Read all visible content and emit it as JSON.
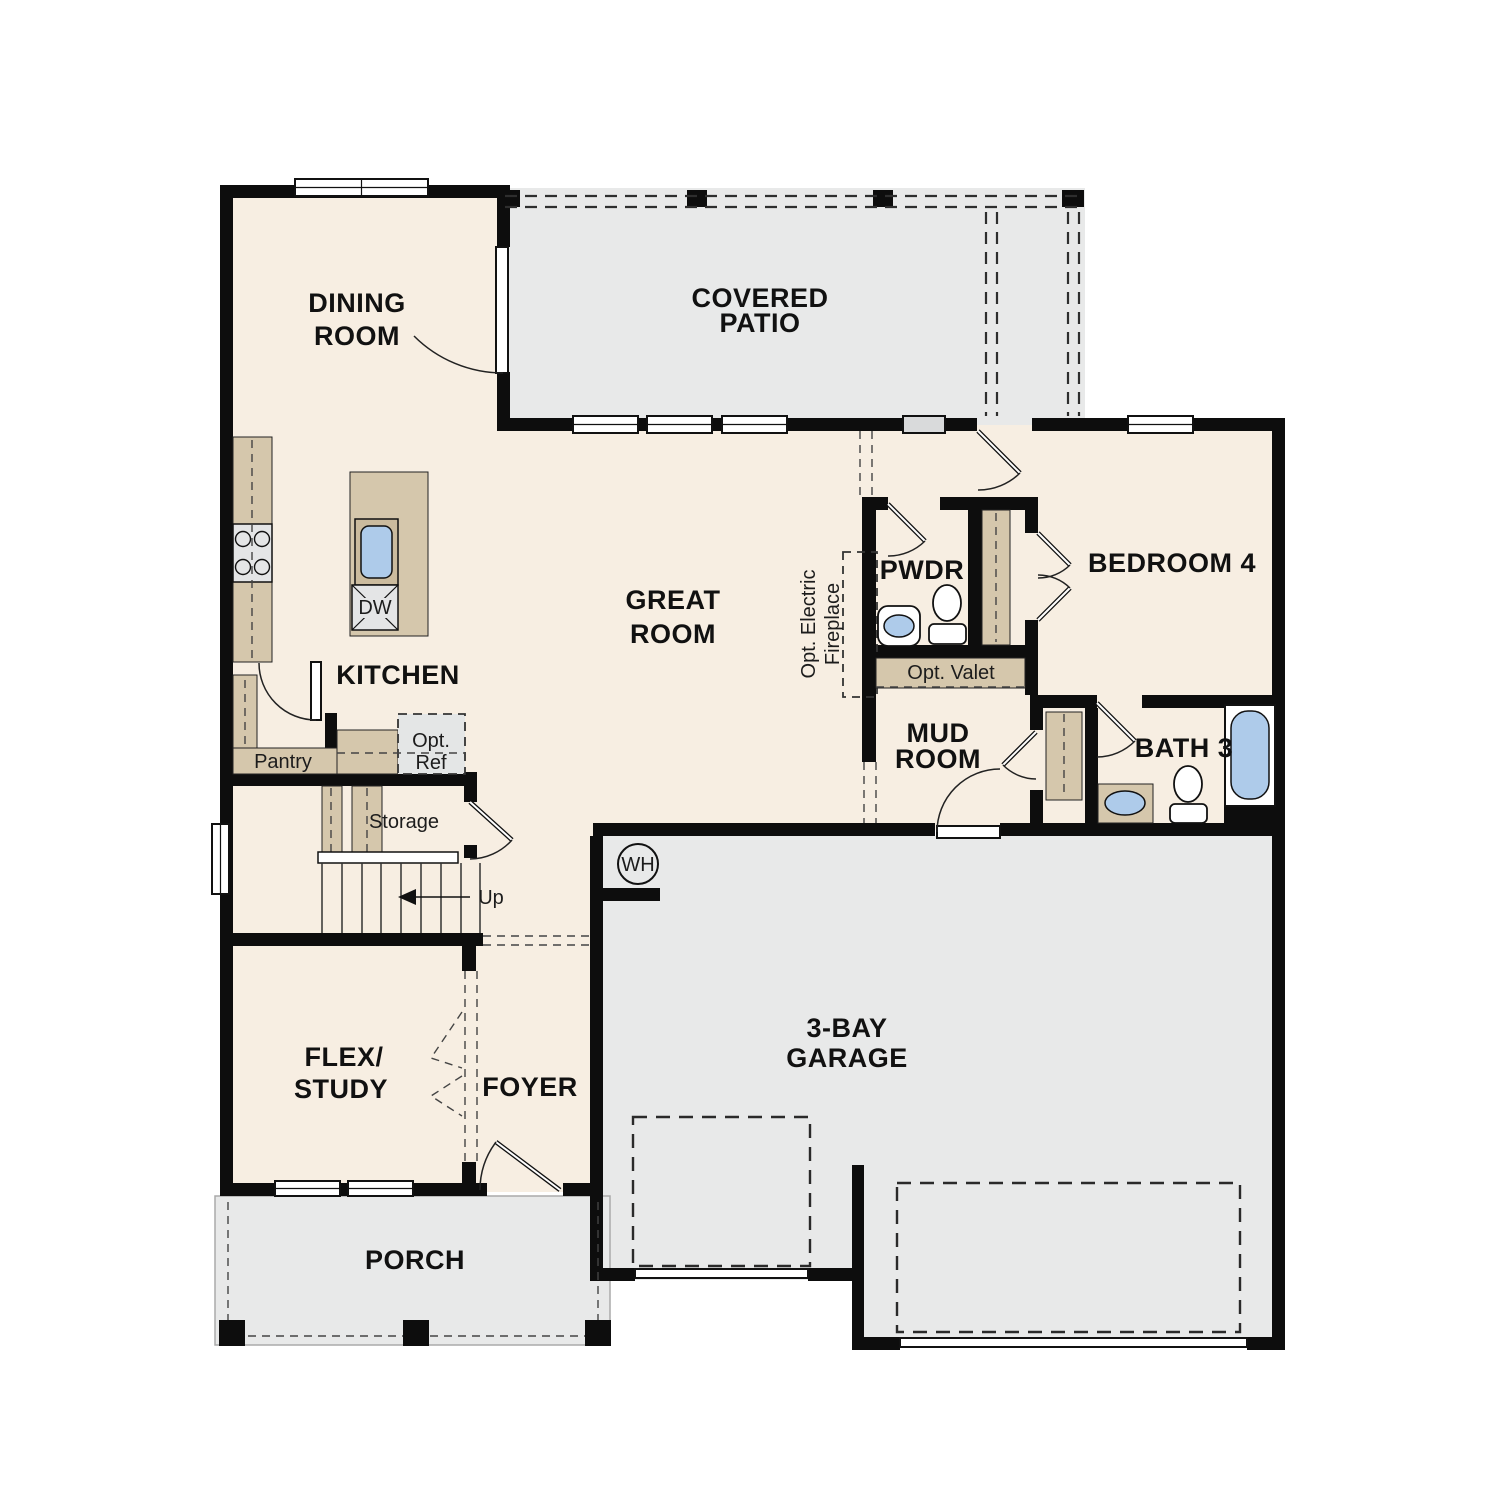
{
  "plan": {
    "rooms": {
      "dining": {
        "line1": "DINING",
        "line2": "ROOM"
      },
      "covered_patio": {
        "line1": "COVERED",
        "line2": "PATIO"
      },
      "great_room": {
        "line1": "GREAT",
        "line2": "ROOM"
      },
      "kitchen": {
        "label": "KITCHEN"
      },
      "pwdr": {
        "label": "PWDR"
      },
      "bedroom_4": {
        "label": "BEDROOM 4"
      },
      "mud_room": {
        "line1": "MUD",
        "line2": "ROOM"
      },
      "bath_3": {
        "label": "BATH 3"
      },
      "flex_study": {
        "line1": "FLEX/",
        "line2": "STUDY"
      },
      "foyer": {
        "label": "FOYER"
      },
      "porch": {
        "label": "PORCH"
      },
      "garage": {
        "line1": "3-BAY",
        "line2": "GARAGE"
      }
    },
    "features": {
      "pantry": "Pantry",
      "storage": "Storage",
      "up": "Up",
      "opt_ref_line1": "Opt.",
      "opt_ref_line2": "Ref",
      "opt_valet": "Opt. Valet",
      "opt_fireplace_line1": "Opt. Electric",
      "opt_fireplace_line2": "Fireplace",
      "dishwasher": "DW",
      "water_heater": "WH"
    },
    "colors": {
      "floor": "#f7eee2",
      "outdoor_concrete": "#e8e9e9",
      "cabinet_tan": "#d5c7ac",
      "fixture_blue": "#aecbea",
      "wall_black": "#0d0d0d"
    }
  }
}
